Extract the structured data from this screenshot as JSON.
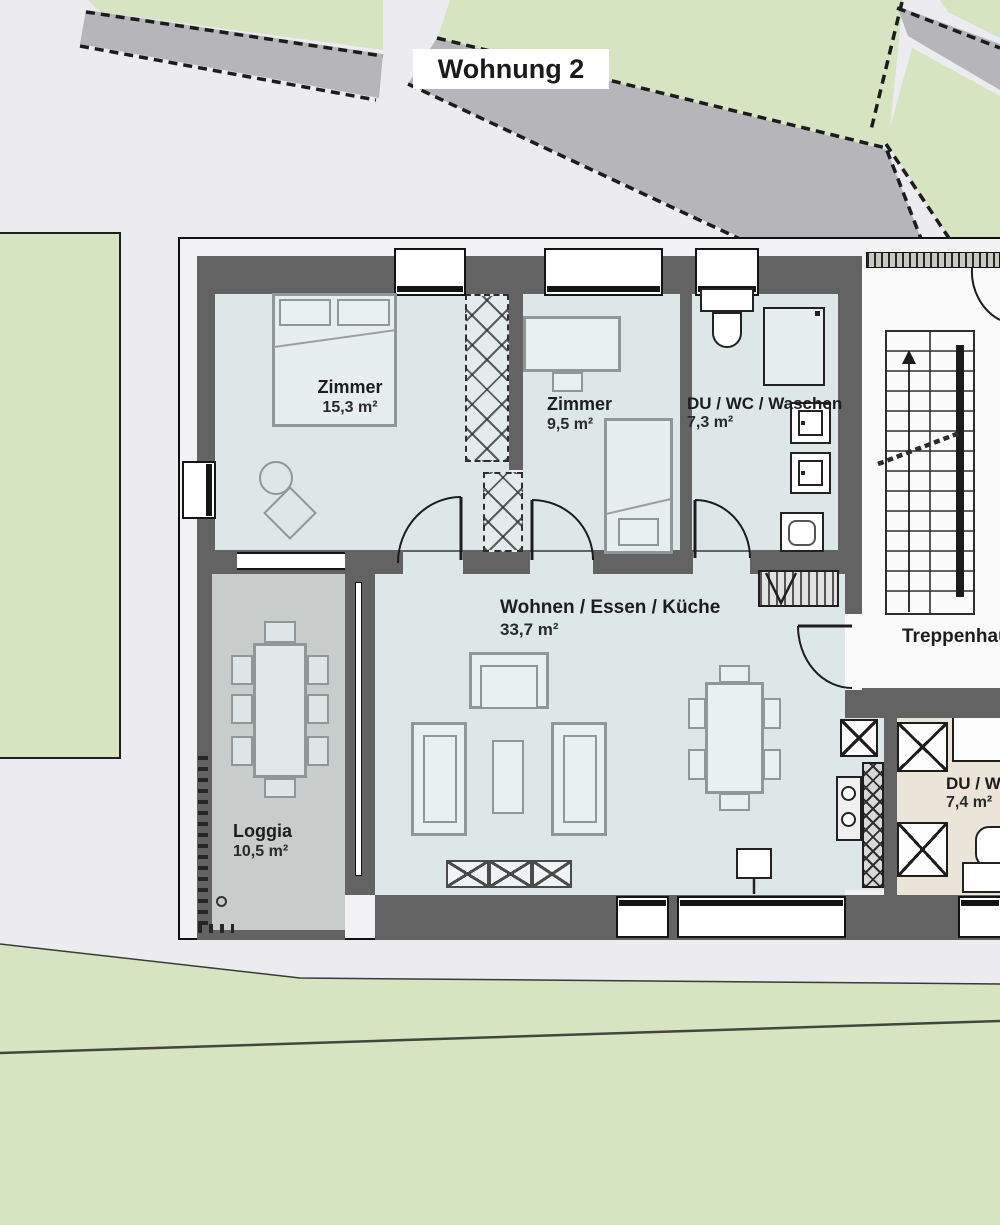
{
  "site": {
    "title": "Wohnung 2"
  },
  "rooms": {
    "zimmer1": {
      "name": "Zimmer",
      "area": "15,3 m²"
    },
    "zimmer2": {
      "name": "Zimmer",
      "area": "9,5 m²"
    },
    "bath": {
      "name": "DU / WC / Waschen",
      "area": "7,3 m²"
    },
    "living": {
      "name": "Wohnen / Essen / Küche",
      "area": "33,7 m²"
    },
    "loggia": {
      "name": "Loggia",
      "area": "10,5 m²"
    },
    "stairwell": {
      "name": "Treppenhaus"
    },
    "bath2": {
      "name": "DU / WC",
      "area": "7,4 m²"
    }
  },
  "colors": {
    "wall": "#636363",
    "room_fill": "#dee7e8",
    "loggia_fill": "#c8cccb",
    "lawn": "#d6e4c1",
    "pavement": "#ecebef",
    "concrete_band": "#b6b6ba",
    "apartment2_fill": "#ebe4d9",
    "stairwell_fill": "#fafafa"
  }
}
